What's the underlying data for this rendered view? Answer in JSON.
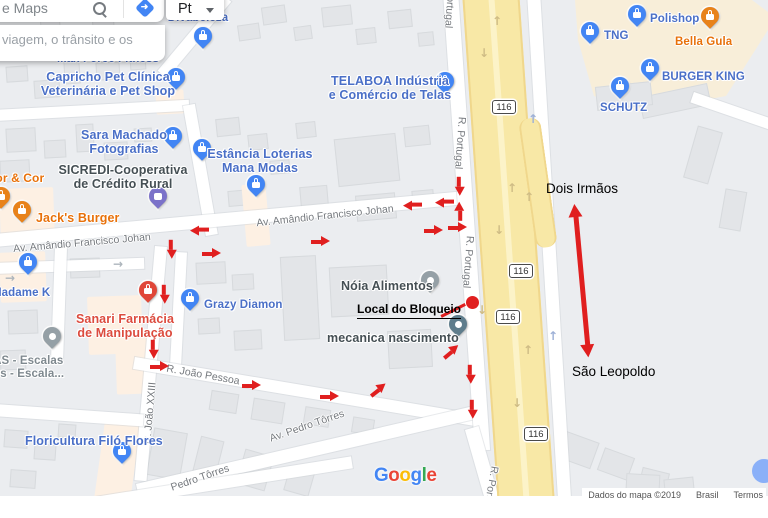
{
  "ui": {
    "search": {
      "placeholder": "e Maps",
      "suggestion": "viagem, o trânsito e os"
    },
    "language_button": {
      "label": "Pt"
    }
  },
  "map": {
    "pois": [
      {
        "id": "divabeleza",
        "lines": [
          "Divabeleza"
        ],
        "style": "blue",
        "size": 11.5,
        "pin": "bag",
        "pin_xy": [
          203,
          36
        ],
        "label_xy": [
          198,
          12
        ],
        "align": "center"
      },
      {
        "id": "max-force-fitness",
        "lines": [
          "Max Force Fitness"
        ],
        "style": "blue",
        "size": 11.5,
        "pin": "none",
        "label_xy": [
          108,
          53
        ],
        "align": "center"
      },
      {
        "id": "capricho-pet-clinica",
        "lines": [
          "Capricho Pet Clínica",
          "Veterinária e Pet Shop"
        ],
        "style": "blue",
        "size": 12.5,
        "pin": "bag",
        "pin_xy": [
          176,
          77
        ],
        "label_xy": [
          108,
          70
        ],
        "align": "center"
      },
      {
        "id": "telaboa",
        "lines": [
          "TELABOA Indústria",
          "e Comércio de Telas"
        ],
        "style": "blue",
        "size": 12.5,
        "pin": "bag",
        "pin_xy": [
          445,
          81
        ],
        "label_xy": [
          390,
          74
        ],
        "align": "center"
      },
      {
        "id": "sara-machado",
        "lines": [
          "Sara Machado",
          "Fotografias"
        ],
        "style": "blue",
        "size": 12.5,
        "pin": "bag",
        "pin_xy": [
          173,
          136
        ],
        "label_xy": [
          124,
          128
        ],
        "align": "center"
      },
      {
        "id": "sicredi",
        "lines": [
          "SICREDI-Cooperativa",
          "de Crédito Rural"
        ],
        "style": "dark",
        "size": 12.5,
        "pin": "bank",
        "pin_xy": [
          158,
          196
        ],
        "label_xy": [
          123,
          163
        ],
        "align": "center"
      },
      {
        "id": "estancia-loterias",
        "lines": [
          "Estância Loterias",
          "Mana Modas"
        ],
        "style": "blue",
        "size": 12.5,
        "pin": "bag",
        "pin_xy": [
          202,
          148
        ],
        "label_xy": [
          260,
          147
        ],
        "align": "center"
      },
      {
        "id": "estancia-pin2",
        "lines": [],
        "style": "blue",
        "size": 11.5,
        "pin": "bag",
        "pin_xy": [
          256,
          184
        ],
        "label_xy": [
          0,
          0
        ],
        "align": "center"
      },
      {
        "id": "jacks-burger",
        "lines": [
          "Jack's Burger"
        ],
        "style": "orange",
        "size": 12.5,
        "pin": "food",
        "pin_xy": [
          22,
          210
        ],
        "label_xy": [
          36,
          211
        ],
        "align": "left"
      },
      {
        "id": "bor-e-cor",
        "lines": [
          "bor & Cor"
        ],
        "style": "orange",
        "size": 12,
        "pin": "food",
        "pin_xy": [
          1,
          196
        ],
        "label_xy": [
          -12,
          172
        ],
        "align": "left"
      },
      {
        "id": "madame-k",
        "lines": [
          "Madame K"
        ],
        "style": "blue",
        "size": 11.5,
        "pin": "bag",
        "pin_xy": [
          28,
          262
        ],
        "label_xy": [
          -8,
          287
        ],
        "align": "left"
      },
      {
        "id": "grazy-diamon",
        "lines": [
          "Grazy Diamon"
        ],
        "style": "blue",
        "size": 11.5,
        "pin": "bag",
        "pin_xy": [
          190,
          298
        ],
        "label_xy": [
          204,
          299
        ],
        "align": "left"
      },
      {
        "id": "sanari-farmacia",
        "lines": [
          "Sanari Farmácia",
          "de Manipulação"
        ],
        "style": "red",
        "size": 12.5,
        "pin": "health",
        "pin_xy": [
          148,
          290
        ],
        "label_xy": [
          125,
          312
        ],
        "align": "center"
      },
      {
        "id": "noia-alimentos",
        "lines": [
          "Nóia Alimentos"
        ],
        "style": "dark",
        "size": 12.5,
        "pin": "gray",
        "pin_xy": [
          430,
          280
        ],
        "label_xy": [
          341,
          279
        ],
        "align": "left"
      },
      {
        "id": "mecanica-nascimento",
        "lines": [
          "mecanica nascimento"
        ],
        "style": "dark",
        "size": 12.5,
        "pin": "slate",
        "pin_xy": [
          458,
          324
        ],
        "label_xy": [
          327,
          331
        ],
        "align": "left"
      },
      {
        "id": "las-escalas",
        "lines": [
          "LAS - Escalas",
          "dos - Escala..."
        ],
        "style": "gray",
        "size": 11.5,
        "pin": "gray",
        "pin_xy": [
          52,
          336
        ],
        "label_xy": [
          -14,
          355
        ],
        "align": "left"
      },
      {
        "id": "floricultura-filo",
        "lines": [
          "Floricultura Filó Flores"
        ],
        "style": "blue",
        "size": 12.5,
        "pin": "bag",
        "pin_xy": [
          122,
          451
        ],
        "label_xy": [
          25,
          434
        ],
        "align": "left"
      },
      {
        "id": "polishop",
        "lines": [
          "Polishop"
        ],
        "style": "blue",
        "size": 11.5,
        "pin": "bag",
        "pin_xy": [
          637,
          14
        ],
        "label_xy": [
          650,
          13
        ],
        "align": "left"
      },
      {
        "id": "bella-gula",
        "lines": [
          "Bella Gula"
        ],
        "style": "orange",
        "size": 11.5,
        "pin": "food",
        "pin_xy": [
          710,
          16
        ],
        "label_xy": [
          675,
          36
        ],
        "align": "left"
      },
      {
        "id": "tng",
        "lines": [
          "TNG"
        ],
        "style": "blue",
        "size": 11.5,
        "pin": "bag",
        "pin_xy": [
          590,
          31
        ],
        "label_xy": [
          604,
          30
        ],
        "align": "left"
      },
      {
        "id": "burger-king",
        "lines": [
          "BURGER KING"
        ],
        "style": "blue",
        "size": 11.5,
        "pin": "bag",
        "pin_xy": [
          650,
          68
        ],
        "label_xy": [
          662,
          71
        ],
        "align": "left"
      },
      {
        "id": "schutz",
        "lines": [
          "SCHUTZ"
        ],
        "style": "blue",
        "size": 11.5,
        "pin": "bag",
        "pin_xy": [
          620,
          86
        ],
        "label_xy": [
          600,
          102
        ],
        "align": "left"
      }
    ],
    "street_labels": [
      {
        "text": "R. Portugal",
        "xy": [
          450,
          2
        ],
        "rot": 94
      },
      {
        "text": "R. Portugal",
        "xy": [
          460,
          143
        ],
        "rot": 94
      },
      {
        "text": "R. Portugal",
        "xy": [
          468,
          262
        ],
        "rot": 94
      },
      {
        "text": "R. Portugal",
        "xy": [
          490,
          492
        ],
        "rot": 100
      },
      {
        "text": "Av. Amândio Francisco Johan",
        "xy": [
          82,
          243
        ],
        "rot": -5
      },
      {
        "text": "Av. Amândio Francisco Johan",
        "xy": [
          325,
          216
        ],
        "rot": -6
      },
      {
        "text": "R. João Pessoa",
        "xy": [
          203,
          375
        ],
        "rot": 10
      },
      {
        "text": "R. João XXIII",
        "xy": [
          150,
          413
        ],
        "rot": -85
      },
      {
        "text": "Av. Pedro Tôrres",
        "xy": [
          307,
          426
        ],
        "rot": -19
      },
      {
        "text": "Pedro Tôrres",
        "xy": [
          200,
          478
        ],
        "rot": -19
      }
    ],
    "shields": [
      {
        "text": "116",
        "xy": [
          504,
          107
        ]
      },
      {
        "text": "116",
        "xy": [
          521,
          271
        ]
      },
      {
        "text": "116",
        "xy": [
          508,
          317
        ]
      },
      {
        "text": "116",
        "xy": [
          536,
          434
        ]
      }
    ],
    "flow_arrows": [
      {
        "xy": [
          497,
          21
        ],
        "glyph": "↑",
        "tone": "tan"
      },
      {
        "xy": [
          484,
          53
        ],
        "glyph": "↓",
        "tone": "tan"
      },
      {
        "xy": [
          533,
          119
        ],
        "glyph": "↑",
        "tone": "blue"
      },
      {
        "xy": [
          512,
          188
        ],
        "glyph": "↑",
        "tone": "tan"
      },
      {
        "xy": [
          529,
          197
        ],
        "glyph": "↑",
        "tone": "tan"
      },
      {
        "xy": [
          499,
          230
        ],
        "glyph": "↓",
        "tone": "tan"
      },
      {
        "xy": [
          482,
          310
        ],
        "glyph": "↓",
        "tone": "tan"
      },
      {
        "xy": [
          528,
          350
        ],
        "glyph": "↑",
        "tone": "tan"
      },
      {
        "xy": [
          517,
          403
        ],
        "glyph": "↓",
        "tone": "tan"
      },
      {
        "xy": [
          553,
          336
        ],
        "glyph": "↑",
        "tone": "blue"
      },
      {
        "xy": [
          118,
          264
        ],
        "glyph": "→",
        "tone": "gray"
      },
      {
        "xy": [
          10,
          278
        ],
        "glyph": "→",
        "tone": "gray"
      }
    ],
    "google_logo": {
      "letters": [
        "G",
        "o",
        "o",
        "g",
        "l",
        "e"
      ],
      "colors": [
        "#4285F4",
        "#EA4335",
        "#FBBC05",
        "#4285F4",
        "#34A853",
        "#EA4335"
      ]
    },
    "attribution": [
      "Dados do mapa ©2019",
      "Brasil",
      "Termos"
    ]
  },
  "annotations": {
    "labels": [
      {
        "id": "dois-irmaos",
        "text": "Dois Irmãos",
        "xy": [
          546,
          181
        ],
        "underline": false
      },
      {
        "id": "sao-leopoldo",
        "text": "São Leopoldo",
        "xy": [
          572,
          364
        ],
        "underline": false
      },
      {
        "id": "local-do-bloqueio",
        "text": "Local do Bloqueio",
        "xy": [
          357,
          302
        ],
        "underline": true
      }
    ],
    "red_arrows": [
      [
        463,
        182,
        90
      ],
      [
        421,
        205,
        180
      ],
      [
        453,
        202,
        180
      ],
      [
        464,
        216,
        -90
      ],
      [
        433,
        231,
        0
      ],
      [
        457,
        228,
        0
      ],
      [
        208,
        230,
        180
      ],
      [
        175,
        245,
        90
      ],
      [
        211,
        254,
        0
      ],
      [
        320,
        242,
        0
      ],
      [
        168,
        290,
        90
      ],
      [
        157,
        345,
        90
      ],
      [
        159,
        367,
        0
      ],
      [
        251,
        386,
        0
      ],
      [
        329,
        397,
        0
      ],
      [
        379,
        393,
        -38
      ],
      [
        452,
        355,
        -40
      ],
      [
        474,
        370,
        90
      ],
      [
        476,
        405,
        90
      ]
    ],
    "double_arrow": {
      "from": [
        575,
        204
      ],
      "to": [
        589,
        357
      ]
    },
    "block_dot": [
      472,
      302
    ],
    "connector": {
      "from": [
        441,
        315
      ],
      "to": [
        465,
        303
      ]
    }
  },
  "colors": {
    "red": "#e01f1f",
    "highway": "#f8e8a6",
    "beige": "#f8eed9",
    "poi_blue": "#4a6fc7",
    "poi_orange": "#e8710a",
    "poi_red": "#dc4b3e",
    "poi_dark": "#454f54",
    "poi_gray": "#7f898f",
    "pin_blue": "#4285f4",
    "pin_orange": "#e8821a",
    "pin_red": "#e04638",
    "pin_purple": "#7b72c9",
    "pin_gray": "#95a0a6",
    "pin_slate": "#5f7d8c",
    "tone_tan": "#cfbc85",
    "tone_blue": "#9db0d6",
    "tone_gray": "#adb5bc"
  }
}
